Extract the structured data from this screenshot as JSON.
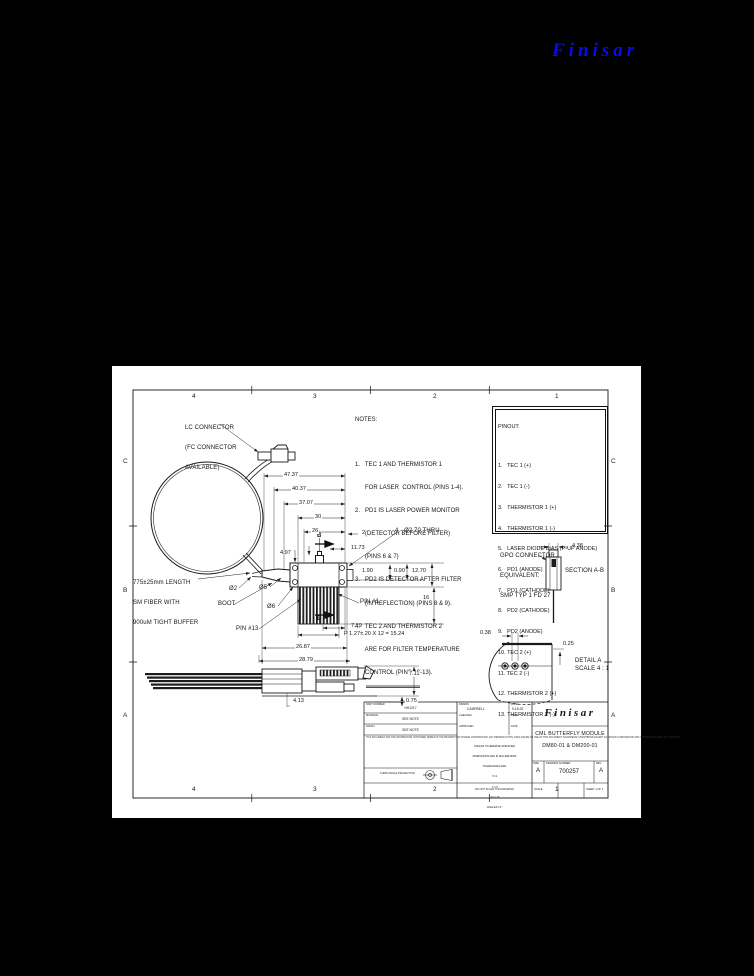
{
  "page_logo": {
    "text": "Finisar",
    "color": "#0a0aee"
  },
  "drawing": {
    "zones": {
      "top": [
        "4",
        "3",
        "2",
        "1"
      ],
      "bottom": [
        "4",
        "3",
        "2",
        "1"
      ],
      "left": [
        "C",
        "B",
        "A"
      ],
      "right": [
        "C",
        "B",
        "A"
      ]
    },
    "notes": {
      "title": "NOTES:",
      "lines": [
        "1.   TEC 1 AND THERMISTOR 1",
        "      FOR LASER  CONTROL (PINS 1-4).",
        "2.   PD1 IS LASER POWER MONITOR",
        "      (DETECTOR BEFORE FILTER)",
        "      (PINS 6 & 7)",
        "3.   PD2 IS DETECTOR AFTER FILTER",
        "      (IN REFLECTION) (PINS 8 & 9).",
        "4.   TEC 2 AND THERMISTOR 2",
        "      ARE FOR FILTER TEMPERATURE",
        "      CONTROL (PINS 10-13)."
      ]
    },
    "pinout": {
      "title": "PINOUT:",
      "pins": [
        "1.   TEC 1 (+)",
        "2.   TEC 1 (-)",
        "3.   THERMISTOR 1 (+)",
        "4.   THERMISTOR 1 (-)",
        "5.   LASER DIODE BIAS (P-UP ANODE)",
        "6.   PD1 (ANODE)",
        "7.   PD1 (CATHODE)",
        "8.   PD2 (CATHODE)",
        "9.   PD2 (ANODE)",
        "10. TEC 2 (+)",
        "11. TEC 2 (-)",
        "12. THERMISTOR 2 (+)",
        "13. THERMISTOR 2 (-)"
      ]
    },
    "callouts": {
      "lc1": "LC CONNECTOR",
      "lc2": "(FC CONNECTOR",
      "lc3": "AVAILABLE)",
      "fiber1": "775±25mm LENGTH",
      "fiber2": "SM FIBER WITH",
      "fiber3": "900uM TIGHT BUFFER",
      "boot": "BOOT",
      "pin1": "PIN #1",
      "pin13": "PIN #13",
      "holes": "4 - Ø2.70 THRU",
      "gpo1": "GPO CONNECTOR",
      "gpo2": "EQUIVALENT:",
      "gpo3": "SMP TYP 1 FD 27",
      "section_label": "SECTION A-B",
      "detail_label": "DETAIL A",
      "detail_scale": "SCALE 4 : 1",
      "section_b": "B"
    },
    "dims": {
      "d4737": "47.37",
      "d4037": "40.37",
      "d3707": "37.07",
      "d30": "30",
      "d26": "26",
      "d2": "2",
      "d1173": "11.73",
      "d497": "4.97",
      "d190": "1.90",
      "d090": "0.90",
      "d1270": "12.70",
      "d16": "16",
      "d719": "7.19",
      "pitch": "P 1.27±.20 X 12 = 15.24",
      "d2687": "26.87",
      "d2879": "28.79",
      "d711": "7.11",
      "d075": "0.75",
      "d413": "4.13",
      "d438": "4.38",
      "d038": "0.38",
      "d025": "0.25",
      "dia2": "Ø2",
      "dia5": "Ø5",
      "dia6": "Ø6"
    },
    "title_block": {
      "company": "Finisar",
      "title1": "CML BUTTERFLY MODULE",
      "title2": "DM80-01 & DM200-01",
      "size_label": "SIZE",
      "size": "A",
      "dwg_label": "DRAWING NUMBER",
      "dwg_no": "700257",
      "rev_label": "REV",
      "rev": "A",
      "scale_label": "SCALE",
      "sheet_label": "SHEET 1 OF 1",
      "fields": [
        {
          "label": "PART NUMBER",
          "value": "HH1217"
        },
        {
          "label": "MATERIAL",
          "value": "SEE NOTE"
        },
        {
          "label": "FINISH",
          "value": "SEE NOTE"
        }
      ],
      "sign_rows": [
        {
          "label": "DRAWN",
          "value": "CAMPBELL",
          "date_label": "DATE",
          "date": "9-18-02"
        },
        {
          "label": "CHECKED",
          "value": "",
          "date_label": "DATE",
          "date": ""
        },
        {
          "label": "APPROVED",
          "value": "",
          "date_label": "DATE",
          "date": ""
        }
      ],
      "tolerances": [
        "UNLESS OTHERWISE SPECIFIED",
        "DIMENSIONS ARE IN MILLIMETERS",
        "TOLERANCES ARE:",
        "X ±1",
        ".X ±.5",
        ".XX ±.25",
        "ANGLES ±1°"
      ],
      "no_scale": "DO NOT SCALE THIS DRAWING",
      "proprietary": "THIS DOCUMENT AND THE INFORMATION CONTAINED HEREIN IS THE PROPERTY OF FINISAR CORPORATION. ANY REPRODUCTION, DISCLOSURE OR USE OF THIS DOCUMENT IS EXPRESSLY PROHIBITED EXCEPT AS FINISAR CORPORATION MAY OTHERWISE AGREE TO IN WRITING.",
      "projection": "THIRD ANGLE PROJECTION"
    }
  }
}
